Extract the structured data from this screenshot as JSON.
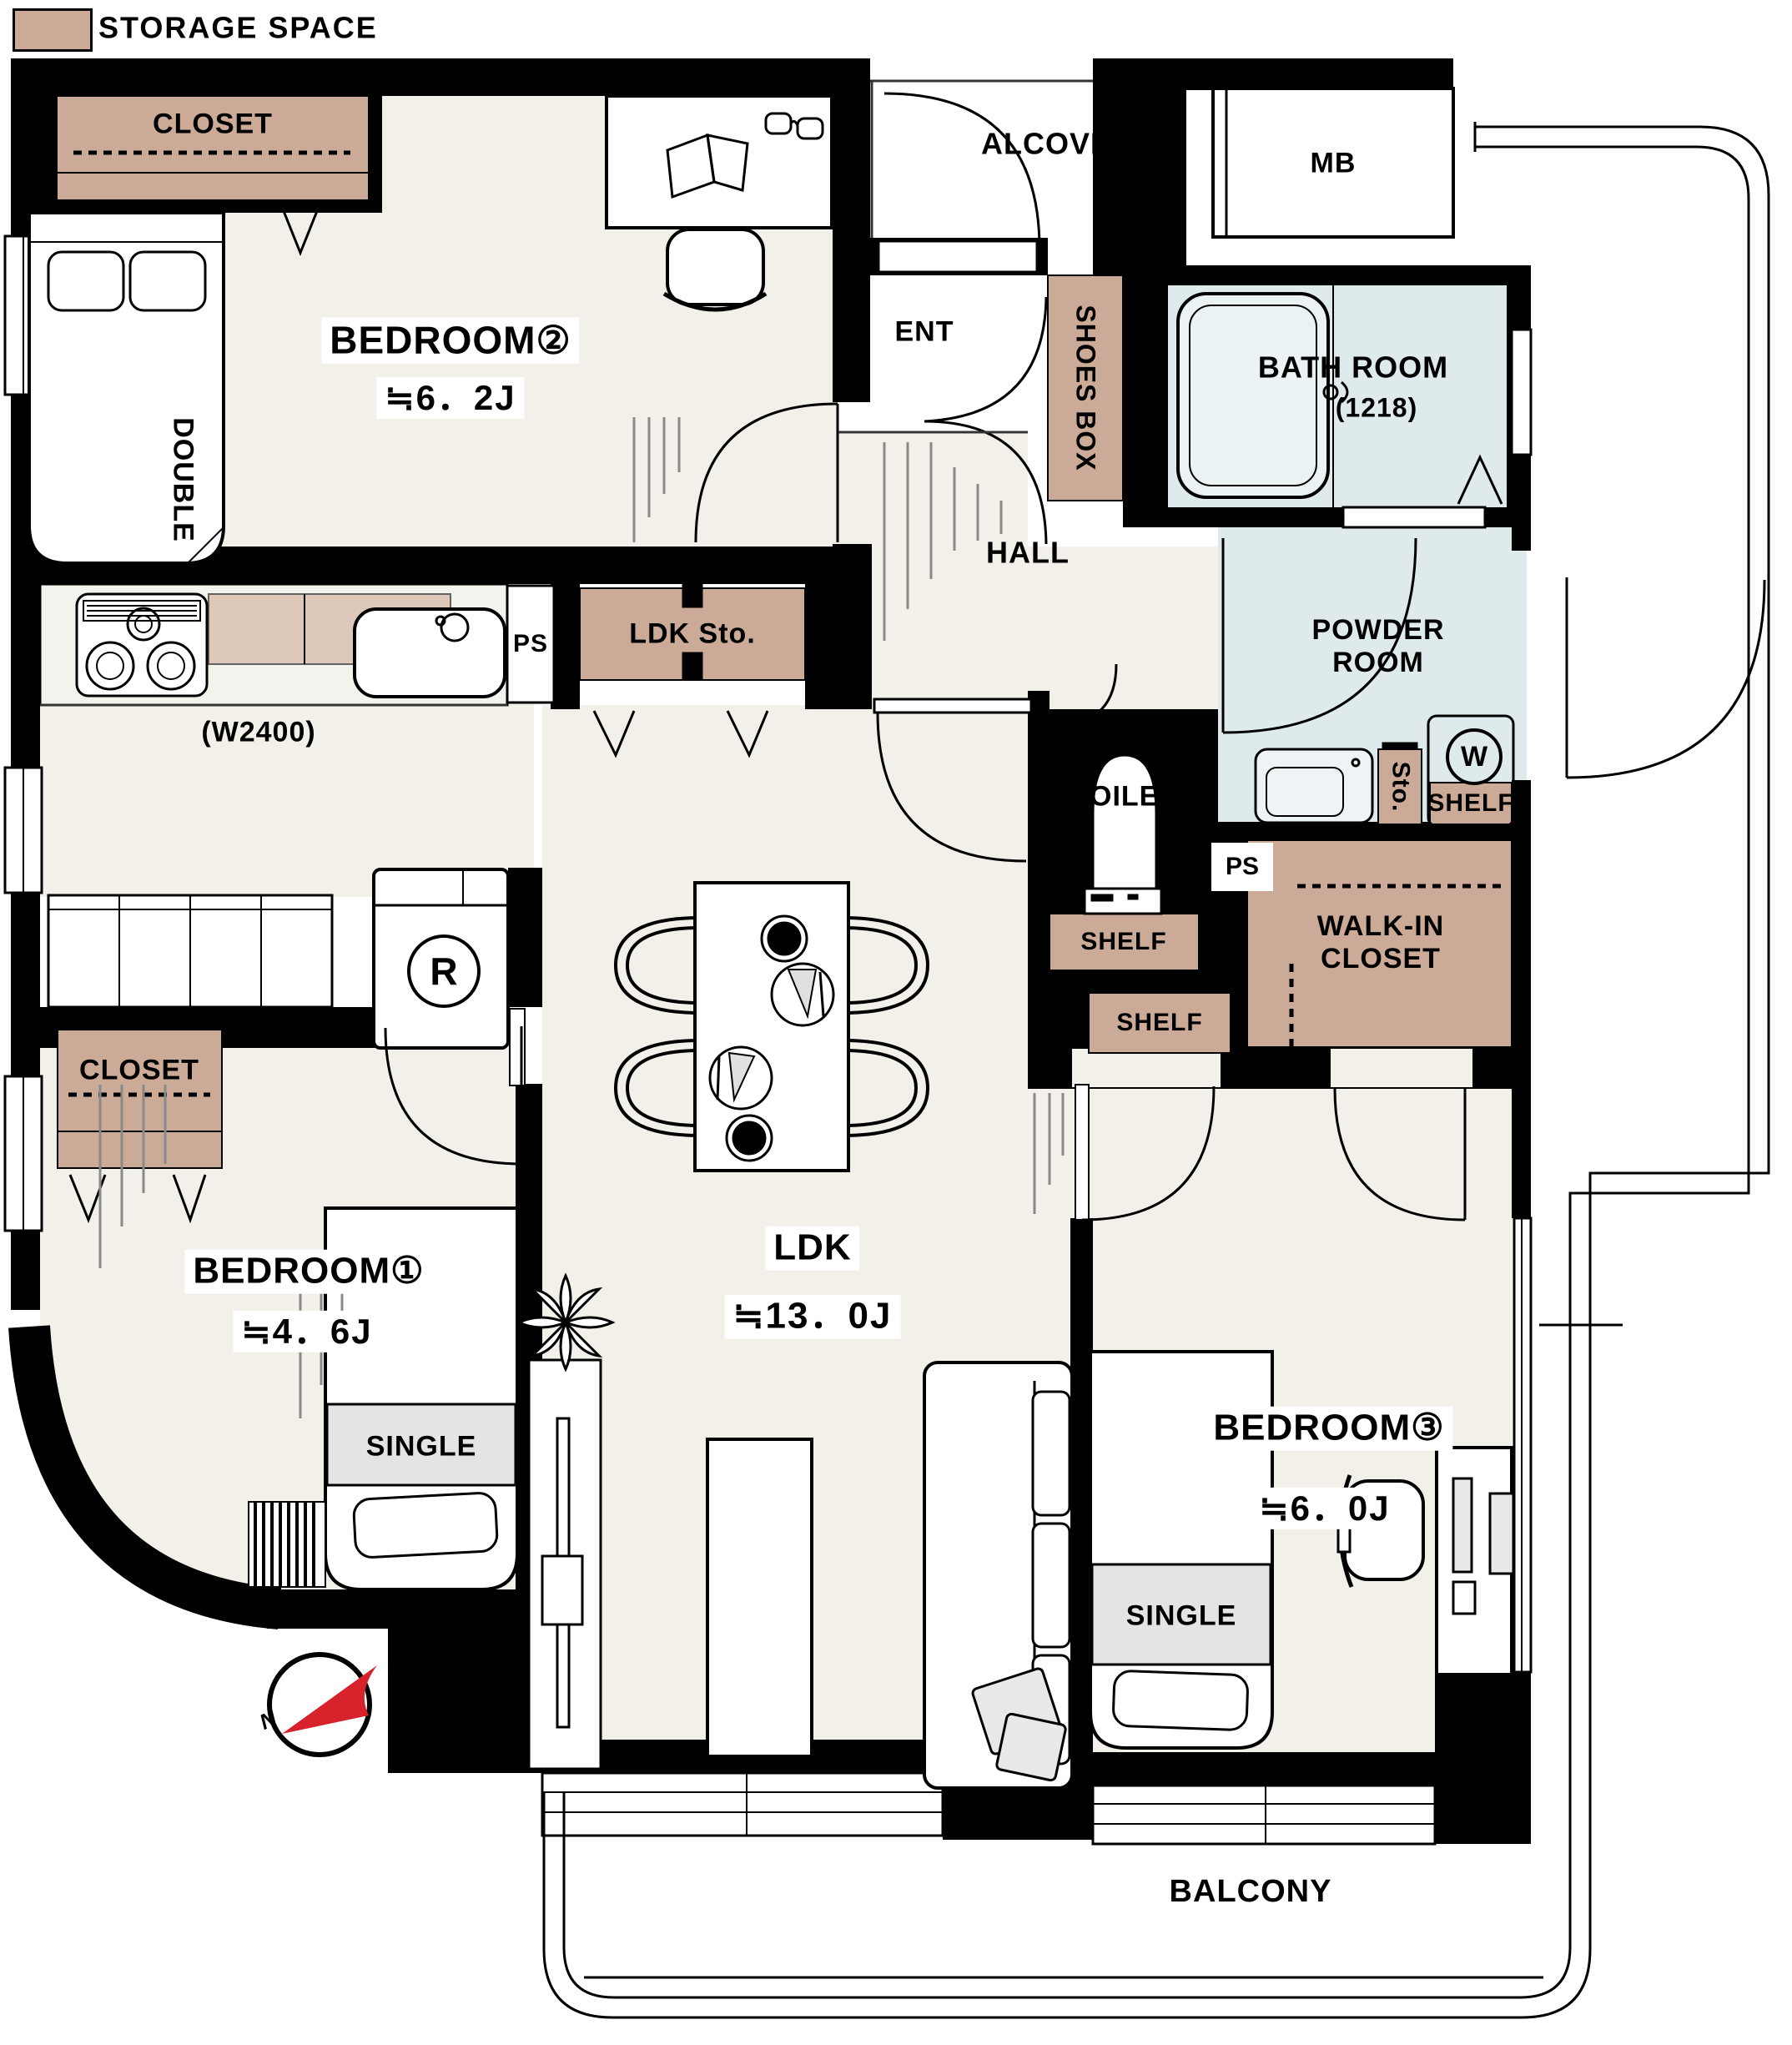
{
  "legend": {
    "label": "STORAGE SPACE",
    "swatch_color": "#cbab97"
  },
  "rooms": {
    "bedroom2": {
      "name": "BEDROOM②",
      "size": "≒6．2J"
    },
    "bedroom1": {
      "name": "BEDROOM①",
      "size": "≒4．6J"
    },
    "bedroom3": {
      "name": "BEDROOM③",
      "size": "≒6．0J"
    },
    "ldk": {
      "name": "LDK",
      "size": "≒13．0J"
    },
    "alcove": {
      "name": "ALCOVE"
    },
    "mb": {
      "name": "MB"
    },
    "ent": {
      "name": "ENT"
    },
    "hall": {
      "name": "HALL"
    },
    "bathroom": {
      "name": "BATH ROOM",
      "size": "(1218)"
    },
    "powder_room": {
      "name": "POWDER ROOM"
    },
    "toilet": {
      "name": "TOILET"
    },
    "balcony": {
      "name": "BALCONY"
    }
  },
  "storage": {
    "closet_bedroom2": "CLOSET",
    "closet_bedroom1": "CLOSET",
    "shoes_box": "SHOES BOX",
    "ldk_storage": "LDK Sto.",
    "powder_storage": "Sto.",
    "walk_in_closet": "WALK-IN CLOSET",
    "shelf_powder": "SHELF",
    "shelf_toilet": "SHELF",
    "shelf_hall": "SHELF"
  },
  "fixtures": {
    "pipe_space_kitchen": "PS",
    "pipe_space_hall": "PS",
    "washing_machine": "W",
    "refrigerator": "R",
    "kitchen_counter_width": "(W2400)"
  },
  "furniture": {
    "bed_double": "DOUBLE",
    "bed_single_1": "SINGLE",
    "bed_single_3": "SINGLE"
  },
  "compass": {
    "north": "N"
  },
  "colors": {
    "storage": "#cbab97",
    "water": "#dfeaec",
    "floor": "#f2f0e9",
    "wall": "#000000",
    "north_arrow": "#d7212b"
  }
}
